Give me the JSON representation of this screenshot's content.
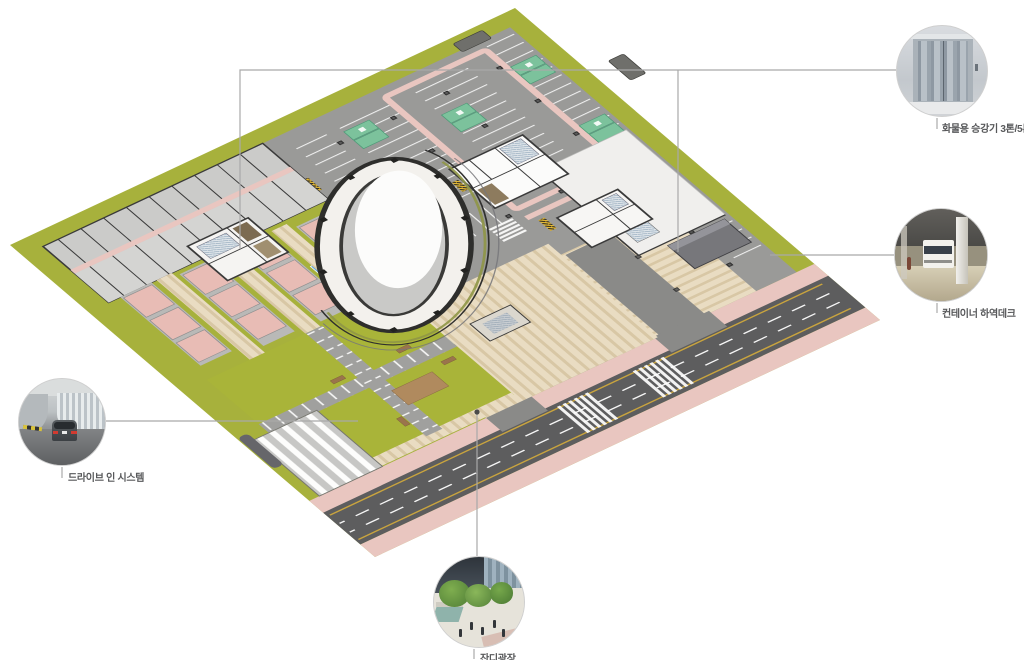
{
  "page": {
    "background": "#ffffff"
  },
  "callouts": {
    "freight_elevator": {
      "label": "화물용 승강기 3톤/5톤",
      "photo": "freight-elevator-photo"
    },
    "container_deck": {
      "label": "컨테이너 하역데크",
      "photo": "container-truck-photo"
    },
    "drive_in": {
      "label": "드라이브 인 시스템",
      "photo": "drive-in-car-photo"
    },
    "lawn_plaza": {
      "label": "잔디광장",
      "photo": "lawn-plaza-photo"
    }
  },
  "colors": {
    "landscape_green": "#a7b13c",
    "lawn_green": "#a9b439",
    "asphalt": "#9a9a98",
    "road": "#5d5d5e",
    "sidewalk_pink": "#e9c6c0",
    "unit_pink": "#e8bcb5",
    "dock_beige": "#e9dcc2",
    "dock_beige_dark": "#d8c7a5",
    "deck_white": "#f0efed",
    "wall_dark": "#3a3a3a",
    "ev_green": "#7cc29c",
    "accessible_blue": "#68a9dc",
    "lane_yellow": "#c9a43e",
    "leader_gray": "#a9a9a9",
    "label_text": "#57585a"
  }
}
